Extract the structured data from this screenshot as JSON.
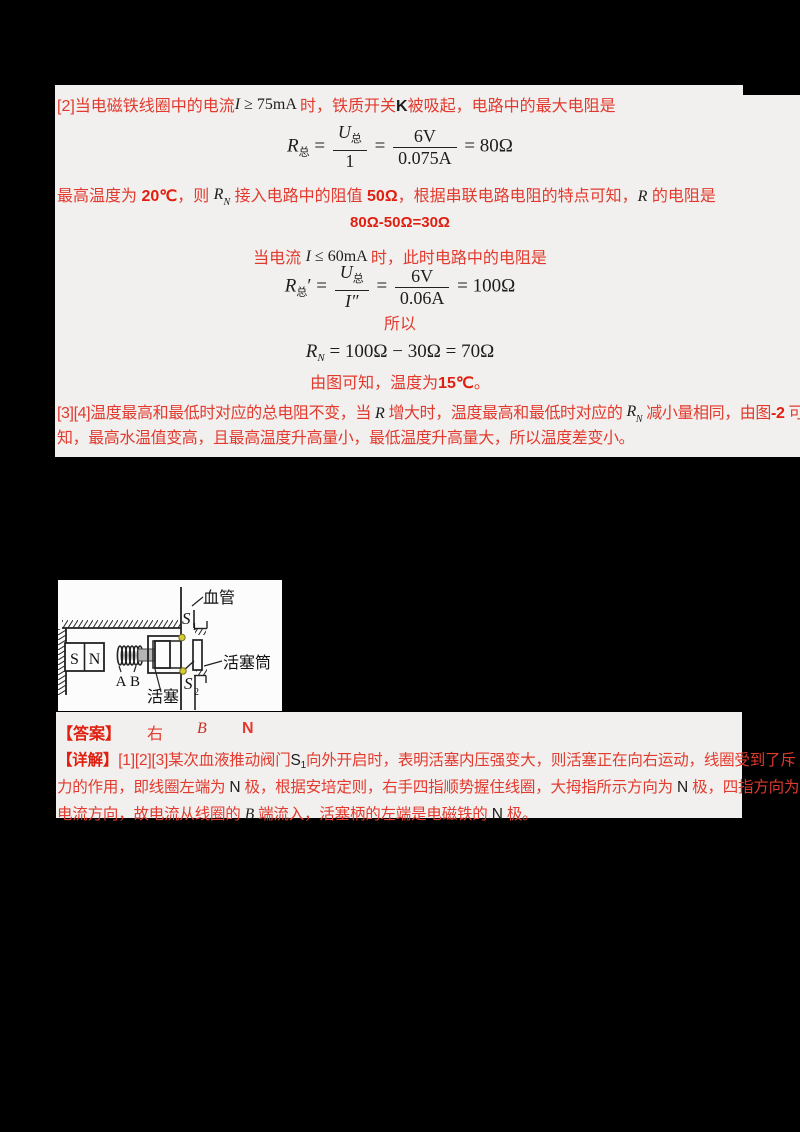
{
  "palette": {
    "background": "#000000",
    "band_bg": "#f1f0ee",
    "diagram_bg": "#fcfcfc",
    "red_text": "#e23a2e",
    "bold_red_text": "#e01f10",
    "dark_text": "#1d1d1d",
    "valve_dot": "#d6ca35"
  },
  "solution": {
    "l1a": "[2]当电磁铁线圈中的电流",
    "l1b_i": "I",
    "l1b_rest": " ≥ 75mA ",
    "l1c": "时，铁质开关",
    "l1d": "K",
    "l1e": "被吸起，电路中的最大电阻是",
    "f1": {
      "r": "R",
      "rsub": "总",
      "eq1": "=",
      "num1": "U",
      "num1sub": "总",
      "den1": "1",
      "eq2": "=",
      "num2": "6V",
      "den2": "0.075A",
      "res": "= 80Ω"
    },
    "l3a": "最高温度为 ",
    "l3b": "20℃",
    "l3c": "，则 ",
    "l3d": "R",
    "l3dsub": "N",
    "l3e": " 接入电路中的阻值 ",
    "l3f": "50Ω",
    "l3g": "，根据串联电路电阻的特点可知，",
    "l3h": "R",
    "l3i": " 的电阻是",
    "l4": "80Ω-50Ω=30Ω",
    "l5a": "当电流 ",
    "l5b": "I",
    "l5c": " ≤ 60mA ",
    "l5d": "时，此时电路中的电阻是",
    "f2": {
      "r": "R",
      "rsub": "总",
      "prime": "′",
      "eq1": "=",
      "num1": "U",
      "num1sub": "总",
      "den1": "I″",
      "eq2": "=",
      "num2": "6V",
      "den2": "0.06A",
      "res": "= 100Ω"
    },
    "l7": "所以",
    "f3": {
      "r": "R",
      "rsub": "N",
      "rest": " = 100Ω − 30Ω = 70Ω"
    },
    "l9a": "由图可知，温度为",
    "l9b": "15℃",
    "l9c": "。",
    "l10a": "[3][4]温度最高和最低时对应的总电阻不变，当 ",
    "l10b": "R",
    "l10c": " 增大时，温度最高和最低时对应的 ",
    "l10d": "R",
    "l10dsub": "N",
    "l10e": " 减小量相同，由图",
    "l10f": "-2",
    "l10g": " 可",
    "l11": "知，最高水温值变高，且最高温度升高量小，最低温度升高量大，所以温度差变小。"
  },
  "diagram": {
    "vessel_label": "血管",
    "cylinder_label": "活塞筒",
    "piston_label": "活塞",
    "valve_s": "S",
    "valve1_sub": "1",
    "valve2_sub": "2",
    "magnet_s": "S",
    "magnet_n": "N",
    "coil_a": "A",
    "coil_b": "B"
  },
  "answer": {
    "label": "【答案】",
    "v1": "右",
    "v2": "B",
    "v3": "N"
  },
  "detail": {
    "label": "【详解】",
    "d1a": "[1][2][3]某次血液推动阀门",
    "d1s": "S",
    "d1ssub": "1",
    "d1b": "向外开启时，表明活塞内压强变大，则活塞正在向右运动，线圈受到了斥",
    "d2a": "力的作用，即线圈左端为 ",
    "d2n1": "N",
    "d2b": " 极，根据安培定则，右手四指顺势握住线圈，大拇指所示方向为 ",
    "d2n2": "N",
    "d2c": " 极，四指方向为",
    "d3a": "电流方向，故电流从线圈的 ",
    "d3b": "B",
    "d3c": " 端流入，活塞柄的左端是电磁铁的 ",
    "d3n": "N",
    "d3d": " 极。"
  }
}
